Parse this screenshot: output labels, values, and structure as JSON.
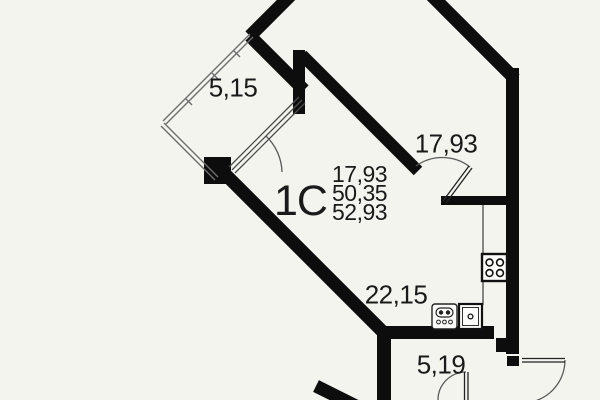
{
  "plan": {
    "unit_label": "1C",
    "area_summary": {
      "living": "17,93",
      "without_balcony": "50,35",
      "total": "52,93"
    },
    "room_labels": {
      "balcony": "5,15",
      "living_room": "17,93",
      "kitchen_living": "22,15",
      "hallway": "5,19"
    },
    "icons": {
      "stove": "stove-icon",
      "sink": "sink-icon",
      "washing_machine": "washing-machine-icon"
    },
    "colors": {
      "wall": "#0d0d0d",
      "background": "#f4f4ef",
      "glazing": "#6e6e6e",
      "door_arc": "#5a5a5a",
      "text": "#1a1a1a"
    }
  }
}
